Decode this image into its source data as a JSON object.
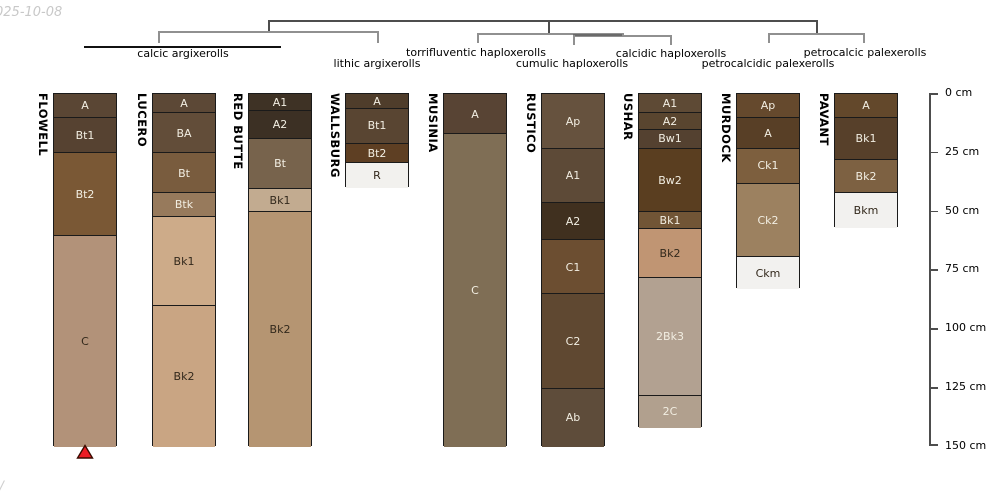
{
  "watermarks": {
    "top_left": "025-10-08",
    "bottom_left": "/"
  },
  "taxonomy_tree": {
    "classes": [
      {
        "label": "calcic argixerolls",
        "cx": 183,
        "top": 47,
        "members": [
          "FLOWELL",
          "LUCERO",
          "RED BUTTE"
        ]
      },
      {
        "label": "lithic argixerolls",
        "cx": 377,
        "top": 56.5,
        "members": [
          "WALLSBURG"
        ]
      },
      {
        "label": "torrifluventic haploxerolls",
        "cx": 476,
        "top": 45.5,
        "members": [
          "MUSINIA"
        ]
      },
      {
        "label": "cumulic haploxerolls",
        "cx": 572,
        "top": 56.5,
        "members": [
          "RUSTICO"
        ]
      },
      {
        "label": "calcidic haploxerolls",
        "cx": 671,
        "top": 46.5,
        "members": [
          "USHAR"
        ]
      },
      {
        "label": "petrocalcidic palexerolls",
        "cx": 768,
        "top": 56.5,
        "members": [
          "MURDOCK"
        ]
      },
      {
        "label": "petrocalcic palexerolls",
        "cx": 865,
        "top": 45.5,
        "members": [
          "PAVANT"
        ]
      }
    ]
  },
  "depth_axis": {
    "unit": "cm",
    "ticks": [
      {
        "label": "0 cm",
        "cm": 0
      },
      {
        "label": "25 cm",
        "cm": 25
      },
      {
        "label": "50 cm",
        "cm": 50
      },
      {
        "label": "75 cm",
        "cm": 75
      },
      {
        "label": "100 cm",
        "cm": 100
      },
      {
        "label": "125 cm",
        "cm": 125
      },
      {
        "label": "150 cm",
        "cm": 150
      }
    ]
  },
  "colors": {
    "light_text": "#f2eee2",
    "dark_text": "#33291c",
    "marker_red": "#ec1c24",
    "marker_outline": "#3a0b00",
    "root_line": "#4d4d4d",
    "branch_line": "#909090",
    "bracket_line": "#111111"
  },
  "profiles": [
    {
      "name": "FLOWELL",
      "x": 53,
      "marker_below": true,
      "horizons": [
        {
          "label": "A",
          "top_cm": 0,
          "bottom_cm": 10,
          "color": "#5a4634",
          "text": "light"
        },
        {
          "label": "Bt1",
          "top_cm": 10,
          "bottom_cm": 25,
          "color": "#564231",
          "text": "light"
        },
        {
          "label": "Bt2",
          "top_cm": 25,
          "bottom_cm": 60,
          "color": "#7a5835",
          "text": "light"
        },
        {
          "label": "C",
          "top_cm": 60,
          "bottom_cm": 150,
          "color": "#b29279",
          "text": "dark"
        }
      ]
    },
    {
      "name": "LUCERO",
      "x": 152,
      "marker_below": false,
      "horizons": [
        {
          "label": "A",
          "top_cm": 0,
          "bottom_cm": 8,
          "color": "#5c4836",
          "text": "light"
        },
        {
          "label": "BA",
          "top_cm": 8,
          "bottom_cm": 25,
          "color": "#624d39",
          "text": "light"
        },
        {
          "label": "Bt",
          "top_cm": 25,
          "bottom_cm": 42,
          "color": "#795c3e",
          "text": "light"
        },
        {
          "label": "Btk",
          "top_cm": 42,
          "bottom_cm": 52,
          "color": "#977a5c",
          "text": "light"
        },
        {
          "label": "Bk1",
          "top_cm": 52,
          "bottom_cm": 90,
          "color": "#cdab89",
          "text": "dark"
        },
        {
          "label": "Bk2",
          "top_cm": 90,
          "bottom_cm": 150,
          "color": "#c9a583",
          "text": "dark"
        }
      ]
    },
    {
      "name": "RED BUTTE",
      "x": 248,
      "marker_below": false,
      "horizons": [
        {
          "label": "A1",
          "top_cm": 0,
          "bottom_cm": 7,
          "color": "#3e3225",
          "text": "light"
        },
        {
          "label": "A2",
          "top_cm": 7,
          "bottom_cm": 19,
          "color": "#3c3024",
          "text": "light"
        },
        {
          "label": "Bt",
          "top_cm": 19,
          "bottom_cm": 40,
          "color": "#77634c",
          "text": "light"
        },
        {
          "label": "Bk1",
          "top_cm": 40,
          "bottom_cm": 50,
          "color": "#c2ab90",
          "text": "dark"
        },
        {
          "label": "Bk2",
          "top_cm": 50,
          "bottom_cm": 150,
          "color": "#b59572",
          "text": "dark"
        }
      ]
    },
    {
      "name": "WALLSBURG",
      "x": 345,
      "marker_below": false,
      "horizons": [
        {
          "label": "A",
          "top_cm": 0,
          "bottom_cm": 6,
          "color": "#4f3d2b",
          "text": "light"
        },
        {
          "label": "Bt1",
          "top_cm": 6,
          "bottom_cm": 21,
          "color": "#594532",
          "text": "light"
        },
        {
          "label": "Bt2",
          "top_cm": 21,
          "bottom_cm": 29,
          "color": "#5e3f23",
          "text": "light"
        },
        {
          "label": "R",
          "top_cm": 29,
          "bottom_cm": 40,
          "color": "#f2f1ee",
          "text": "dark"
        }
      ]
    },
    {
      "name": "MUSINIA",
      "x": 443,
      "marker_below": false,
      "horizons": [
        {
          "label": "A",
          "top_cm": 0,
          "bottom_cm": 17,
          "color": "#584434",
          "text": "light"
        },
        {
          "label": "C",
          "top_cm": 17,
          "bottom_cm": 150,
          "color": "#7f6e55",
          "text": "light"
        }
      ]
    },
    {
      "name": "RUSTICO",
      "x": 541,
      "marker_below": false,
      "horizons": [
        {
          "label": "Ap",
          "top_cm": 0,
          "bottom_cm": 23,
          "color": "#66523e",
          "text": "light"
        },
        {
          "label": "A1",
          "top_cm": 23,
          "bottom_cm": 46,
          "color": "#5d4a37",
          "text": "light"
        },
        {
          "label": "A2",
          "top_cm": 46,
          "bottom_cm": 62,
          "color": "#40301f",
          "text": "light"
        },
        {
          "label": "C1",
          "top_cm": 62,
          "bottom_cm": 85,
          "color": "#6c4e31",
          "text": "light"
        },
        {
          "label": "C2",
          "top_cm": 85,
          "bottom_cm": 125,
          "color": "#5f4831",
          "text": "light"
        },
        {
          "label": "Ab",
          "top_cm": 125,
          "bottom_cm": 150,
          "color": "#5e4c3a",
          "text": "light"
        }
      ]
    },
    {
      "name": "USHAR",
      "x": 638,
      "marker_below": false,
      "horizons": [
        {
          "label": "A1",
          "top_cm": 0,
          "bottom_cm": 8,
          "color": "#5e4a35",
          "text": "light"
        },
        {
          "label": "A2",
          "top_cm": 8,
          "bottom_cm": 15,
          "color": "#59452f",
          "text": "light"
        },
        {
          "label": "Bw1",
          "top_cm": 15,
          "bottom_cm": 23,
          "color": "#544130",
          "text": "light"
        },
        {
          "label": "Bw2",
          "top_cm": 23,
          "bottom_cm": 50,
          "color": "#5a3e20",
          "text": "light"
        },
        {
          "label": "Bk1",
          "top_cm": 50,
          "bottom_cm": 57,
          "color": "#715536",
          "text": "light"
        },
        {
          "label": "Bk2",
          "top_cm": 57,
          "bottom_cm": 78,
          "color": "#c09573",
          "text": "dark"
        },
        {
          "label": "2Bk3",
          "top_cm": 78,
          "bottom_cm": 128,
          "color": "#b2a191",
          "text": "light"
        },
        {
          "label": "2C",
          "top_cm": 128,
          "bottom_cm": 142,
          "color": "#b1a08e",
          "text": "light"
        }
      ]
    },
    {
      "name": "MURDOCK",
      "x": 736,
      "marker_below": false,
      "horizons": [
        {
          "label": "Ap",
          "top_cm": 0,
          "bottom_cm": 10,
          "color": "#65492d",
          "text": "light"
        },
        {
          "label": "A",
          "top_cm": 10,
          "bottom_cm": 23,
          "color": "#583f26",
          "text": "light"
        },
        {
          "label": "Ck1",
          "top_cm": 23,
          "bottom_cm": 38,
          "color": "#7d5f3e",
          "text": "light"
        },
        {
          "label": "Ck2",
          "top_cm": 38,
          "bottom_cm": 69,
          "color": "#9c8160",
          "text": "light"
        },
        {
          "label": "Ckm",
          "top_cm": 69,
          "bottom_cm": 83,
          "color": "#f2f1ef",
          "text": "dark"
        }
      ]
    },
    {
      "name": "PAVANT",
      "x": 834,
      "marker_below": false,
      "horizons": [
        {
          "label": "A",
          "top_cm": 0,
          "bottom_cm": 10,
          "color": "#63482b",
          "text": "light"
        },
        {
          "label": "Bk1",
          "top_cm": 10,
          "bottom_cm": 28,
          "color": "#57402a",
          "text": "light"
        },
        {
          "label": "Bk2",
          "top_cm": 28,
          "bottom_cm": 42,
          "color": "#7d6142",
          "text": "light"
        },
        {
          "label": "Bkm",
          "top_cm": 42,
          "bottom_cm": 57,
          "color": "#f2f1ef",
          "text": "dark"
        }
      ]
    }
  ]
}
